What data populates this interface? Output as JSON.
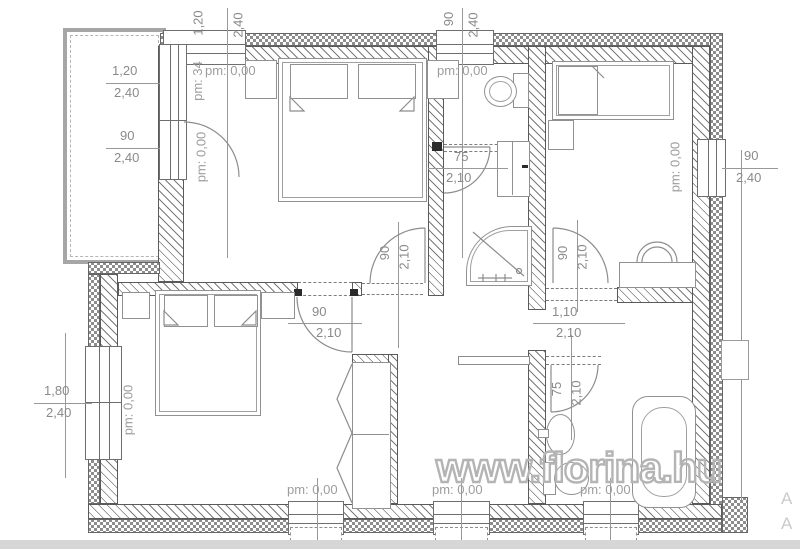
{
  "plan": {
    "watermark": "www.florina.hu",
    "edge_letters": [
      "A",
      "A"
    ],
    "dims": [
      {
        "name": "top-window-left",
        "w": "1,20",
        "h": "2,40"
      },
      {
        "name": "top-window-wc",
        "w": "90",
        "h": "2,40"
      },
      {
        "name": "left-window-upper",
        "w": "1,20",
        "h": "2,40"
      },
      {
        "name": "terrace-door",
        "w": "90",
        "h": "2,40"
      },
      {
        "name": "right-window",
        "w": "90",
        "h": "2,40"
      },
      {
        "name": "left-window-lower",
        "w": "1,80",
        "h": "2,40"
      },
      {
        "name": "wc-door",
        "w": "75",
        "h": "2,10"
      },
      {
        "name": "shower-room-door",
        "w": "90",
        "h": "2,10"
      },
      {
        "name": "bedroom-right-door",
        "w": "90",
        "h": "2,10"
      },
      {
        "name": "hall-bedroom-door",
        "w": "90",
        "h": "2,10"
      },
      {
        "name": "hall-opening",
        "w": "1,10",
        "h": "2,10"
      },
      {
        "name": "bathroom-door",
        "w": "75",
        "h": "2,10"
      }
    ],
    "levels": [
      {
        "name": "bedroom-top-left",
        "text": "pm: 0,00"
      },
      {
        "name": "terrace-window",
        "text": "pm: 34"
      },
      {
        "name": "terrace-door",
        "text": "pm: 0,00"
      },
      {
        "name": "wc",
        "text": "pm: 0,00"
      },
      {
        "name": "right-window",
        "text": "pm: 0,00"
      },
      {
        "name": "left-window-lower",
        "text": "pm: 0,00"
      },
      {
        "name": "bottom-window-1",
        "text": "pm: 0,00"
      },
      {
        "name": "bottom-window-2",
        "text": "pm: 0,00"
      },
      {
        "name": "bottom-window-3",
        "text": "pm: 0,00"
      }
    ]
  }
}
